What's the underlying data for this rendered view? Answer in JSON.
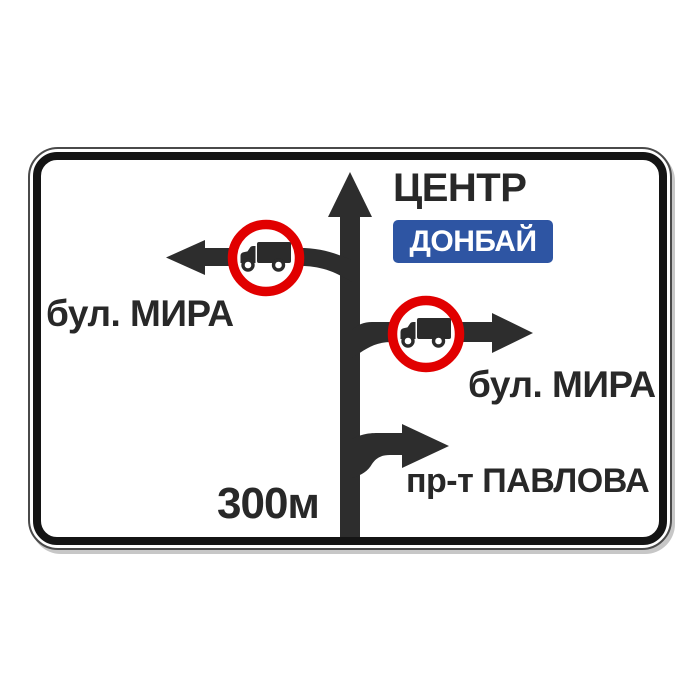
{
  "sign": {
    "type": "advance-direction-road-sign",
    "directions": {
      "straight": {
        "destination": "ЦЕНТР",
        "badge": "ДОНБАЙ",
        "restriction": "none"
      },
      "left": {
        "destination": "бул. МИРА",
        "restriction": "no-heavy-trucks"
      },
      "right": {
        "destination": "бул. МИРА",
        "restriction": "no-heavy-trucks"
      },
      "right_slip": {
        "destination": "пр-т ПАВЛОВА",
        "restriction": "none"
      }
    },
    "distance": "300м",
    "colors": {
      "badge_blue": "#2E55A3",
      "prohibition_red": "#E10000",
      "arrow_dark": "#2D2D2D",
      "plate_white": "#FFFFFF",
      "border_black": "#141414"
    },
    "icons": {
      "restriction_icon": "truck-prohibition-icon"
    }
  }
}
